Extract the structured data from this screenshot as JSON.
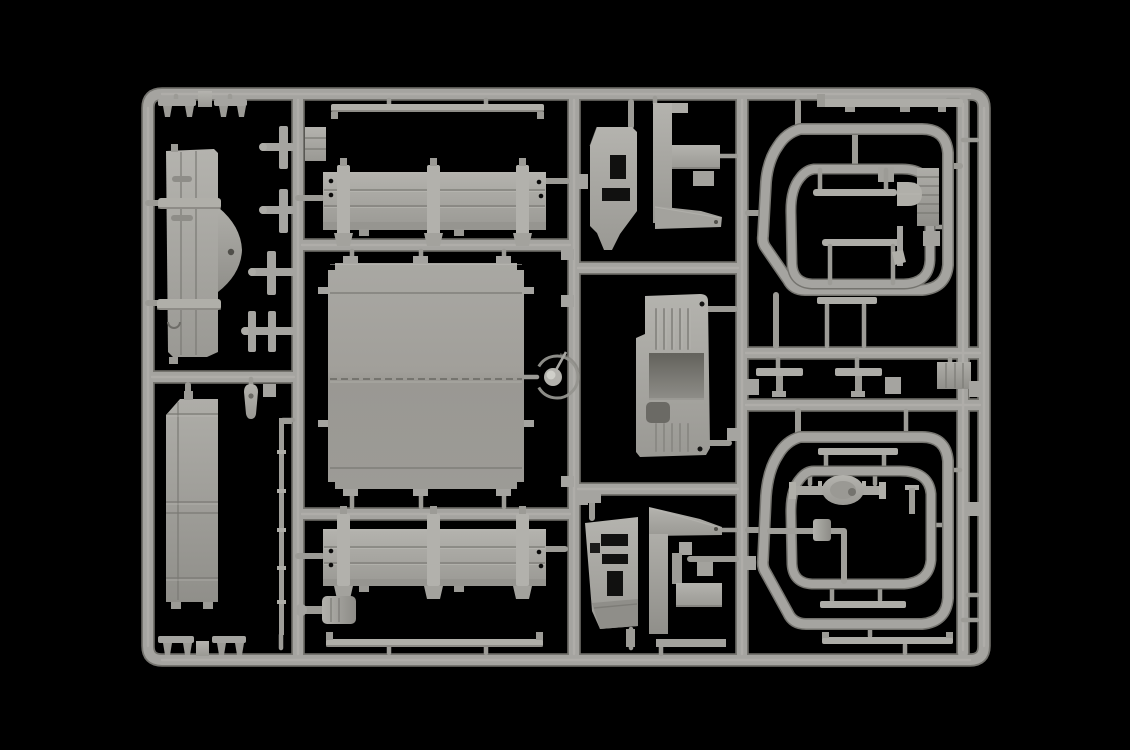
{
  "scene": {
    "description": "Photograph of a light grey injection-molded plastic model kit sprue (parts tree) for a truck model, laid on a pure black background",
    "media_type": "photograph",
    "orientation": "landscape",
    "alt_text": "Light grey plastic sprue frame holding unassembled truck model parts: cargo bed floor, two bed side panels with stake posts, body side panel with fender bulge, ribbed tailgate, cab cowl panels, a ribbed door panel with recessed window, two rounded tarpaulin bow frames containing pioneer tools, a rear axle with differential, an exhaust pipe with muffler, and many small brackets, rails and pins, all joined by grey runners on a black background."
  },
  "palette": {
    "background": "#000000",
    "runner": "#a5a4a0",
    "runner_shadow": "#75746f",
    "runner_highlight": "#c3c2bd",
    "panel_light": "#b4b3ae",
    "panel": "#a8a7a2",
    "panel_mid": "#989792",
    "panel_shadow": "#82817c",
    "recess": "#6e6d68",
    "hole_dark": "#0a0a0a"
  },
  "sprue": {
    "material": "grey styrene plastic",
    "columns": 4,
    "parts": [
      {
        "id": "clip-bars-top-left",
        "label": "Small clip bars with mounting feet"
      },
      {
        "id": "body-side-panel",
        "label": "Truck body side panel with fender bulge and hinge rails"
      },
      {
        "id": "stake-bracket-set",
        "label": "Stake brackets and mounting cleats"
      },
      {
        "id": "teardrop-lamp",
        "label": "Teardrop lamp housing"
      },
      {
        "id": "tailgate-panel",
        "label": "Ribbed tailgate panel"
      },
      {
        "id": "tie-rod",
        "label": "Long thin tie rod"
      },
      {
        "id": "clip-bars-bottom-left",
        "label": "Small clip bars with mounting feet"
      },
      {
        "id": "upper-rail",
        "label": "Narrow bed rail strip"
      },
      {
        "id": "bed-side-upper",
        "label": "Cargo bed side panel with stake posts"
      },
      {
        "id": "bed-floor",
        "label": "Large cargo bed floor panel"
      },
      {
        "id": "hub-ring",
        "label": "Wheel hub ring with center cap"
      },
      {
        "id": "bed-side-lower",
        "label": "Cargo bed side panel with stake posts"
      },
      {
        "id": "lower-rail",
        "label": "Narrow bed rail strip"
      },
      {
        "id": "air-filter",
        "label": "Air filter canister"
      },
      {
        "id": "latch-plate",
        "label": "Small latch plate"
      },
      {
        "id": "cowl-upper-left",
        "label": "Cab cowl panel with vent openings"
      },
      {
        "id": "bracket-upper-right",
        "label": "Mounting bracket with wedge arm"
      },
      {
        "id": "cab-door",
        "label": "Ribbed door panel with recessed window"
      },
      {
        "id": "cowl-lower-left",
        "label": "Cab cowl panel with vent openings"
      },
      {
        "id": "bracket-lower-right",
        "label": "Mounting bracket with wedge arm"
      },
      {
        "id": "chassis-bar-top",
        "label": "Straight chassis bar"
      },
      {
        "id": "tarp-frame-upper-outer",
        "label": "Tarpaulin bow frame, outer loop"
      },
      {
        "id": "tarp-frame-upper-inner",
        "label": "Tarpaulin bow frame, inner loop"
      },
      {
        "id": "shovel",
        "label": "Shovel pioneer tool"
      },
      {
        "id": "axe",
        "label": "Axe pioneer tool"
      },
      {
        "id": "tool-board",
        "label": "Ribbed tool stowage board"
      },
      {
        "id": "linkage-set",
        "label": "Linkage rods and fittings"
      },
      {
        "id": "tarp-frame-lower-outer",
        "label": "Tarpaulin bow frame, outer loop"
      },
      {
        "id": "tarp-frame-lower-inner",
        "label": "Tarpaulin bow frame, inner loop"
      },
      {
        "id": "rear-axle",
        "label": "Rear axle with differential housing"
      },
      {
        "id": "exhaust",
        "label": "Exhaust pipe with muffler"
      },
      {
        "id": "chassis-bars-bottom",
        "label": "Straight chassis bars"
      }
    ]
  }
}
